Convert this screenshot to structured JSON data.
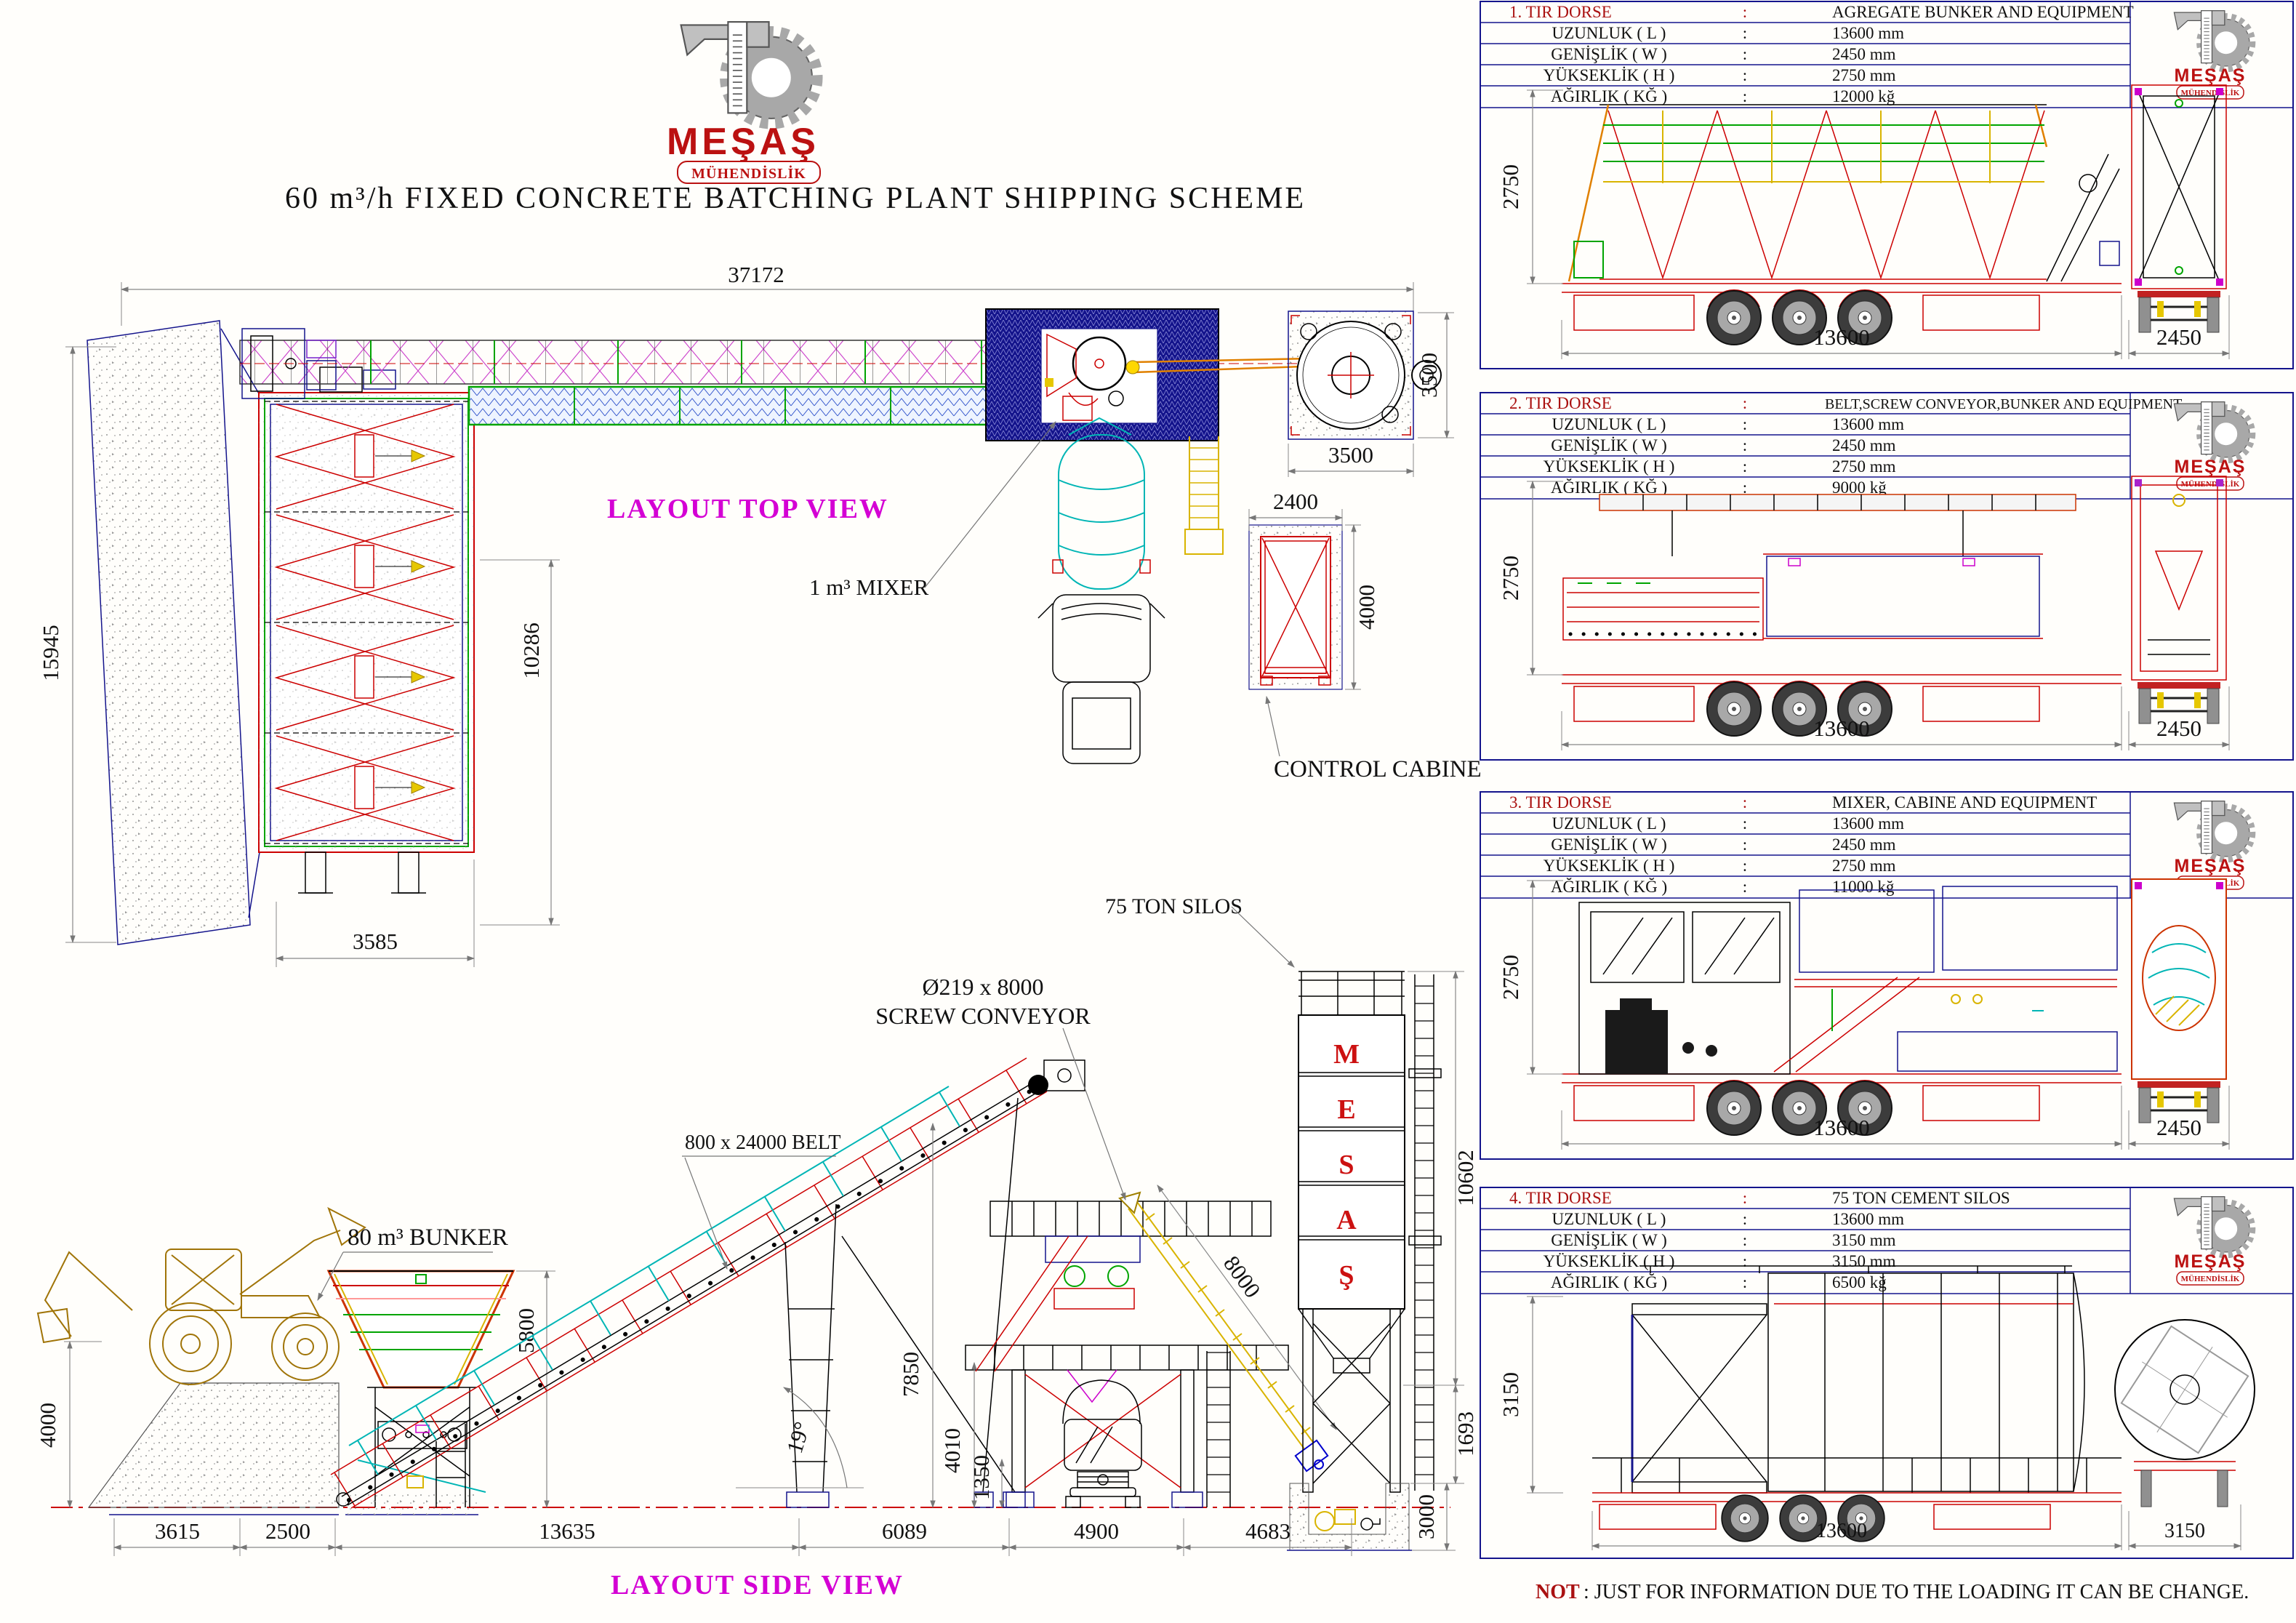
{
  "title": "60 m³/h FIXED CONCRETE BATCHING PLANT SHIPPING SCHEME",
  "logo": {
    "brand": "MEŞAŞ",
    "subtitle": "MÜHENDİSLİK"
  },
  "colors": {
    "cad_red": "#cc0000",
    "cad_navy": "#14148c",
    "cad_green": "#00a400",
    "cad_cyan": "#00b5b5",
    "cad_yellow": "#d9b400",
    "cad_magenta": "#cc00cc",
    "label_magenta": "#d400d4",
    "brand_red": "#bb1111"
  },
  "table_ui": {
    "colon": ":"
  },
  "top_view": {
    "view_label": "LAYOUT TOP VIEW",
    "mixer_label": "1 m³ MIXER",
    "control_cabine_label": "CONTROL CABINE",
    "dim_total_width": "37172",
    "dim_left_height": "15945",
    "dim_bunker_length": "10286",
    "dim_bunker_width": "3585",
    "dim_silo_side": "3500",
    "dim_silo_front": "3500",
    "dim_cabine_width": "2400",
    "dim_cabine_depth": "4000"
  },
  "side_view": {
    "view_label": "LAYOUT SIDE VIEW",
    "bunker_label": "80 m³ BUNKER",
    "belt_label": "800 x 24000 BELT",
    "screw_label_line1": "Ø219 x 8000",
    "screw_label_line2": "SCREW CONVEYOR",
    "silos_label": "75 TON SILOS",
    "silo_letters": [
      "M",
      "E",
      "S",
      "A",
      "Ş"
    ],
    "dim_ramp_height": "4000",
    "dim_bunker_height": "5800",
    "dim_belt_angle": "19°",
    "dim_platform_height": "7850",
    "dim_truck_clearance": "4010",
    "dim_footing_height": "1350",
    "dim_screw_length": "8000",
    "dim_silo_height": "10602",
    "dim_silo_cone": "1693",
    "dim_foundation_depth": "3000",
    "dim_ramp_length": "3615",
    "dim_feeder_gap": "2500",
    "dim_belt_span": "13635",
    "dim_mid_span": "6089",
    "dim_leg_span": "4900",
    "dim_silo_span": "4683"
  },
  "trucks": [
    {
      "no": "1. TIR DORSE",
      "cargo": "AGREGATE BUNKER AND EQUIPMENT",
      "rows": [
        {
          "label": "UZUNLUK ( L )",
          "value": "13600 mm"
        },
        {
          "label": "GENİŞLİK ( W )",
          "value": "2450 mm"
        },
        {
          "label": "YÜKSEKLİK ( H )",
          "value": "2750 mm"
        },
        {
          "label": "AĞIRLIK ( KĞ )",
          "value": "12000 kğ"
        }
      ],
      "dim_height": "2750",
      "dim_length": "13600",
      "dim_width": "2450"
    },
    {
      "no": "2. TIR DORSE",
      "cargo": "BELT,SCREW CONVEYOR,BUNKER AND EQUIPMENT",
      "rows": [
        {
          "label": "UZUNLUK ( L )",
          "value": "13600 mm"
        },
        {
          "label": "GENİŞLİK ( W )",
          "value": "2450 mm"
        },
        {
          "label": "YÜKSEKLİK ( H )",
          "value": "2750 mm"
        },
        {
          "label": "AĞIRLIK ( KĞ )",
          "value": "9000 kğ"
        }
      ],
      "dim_height": "2750",
      "dim_length": "13600",
      "dim_width": "2450"
    },
    {
      "no": "3. TIR DORSE",
      "cargo": "MIXER, CABINE AND EQUIPMENT",
      "rows": [
        {
          "label": "UZUNLUK ( L )",
          "value": "13600 mm"
        },
        {
          "label": "GENİŞLİK ( W )",
          "value": "2450 mm"
        },
        {
          "label": "YÜKSEKLİK ( H )",
          "value": "2750 mm"
        },
        {
          "label": "AĞIRLIK ( KĞ )",
          "value": "11000 kğ"
        }
      ],
      "dim_height": "2750",
      "dim_length": "13600",
      "dim_width": "2450"
    },
    {
      "no": "4. TIR DORSE",
      "cargo": "75 TON CEMENT SILOS",
      "rows": [
        {
          "label": "UZUNLUK ( L )",
          "value": "13600 mm"
        },
        {
          "label": "GENİŞLİK ( W )",
          "value": "3150 mm"
        },
        {
          "label": "YÜKSEKLİK ( H )",
          "value": "3150 mm"
        },
        {
          "label": "AĞIRLIK ( KĞ )",
          "value": "6500 kğ"
        }
      ],
      "dim_height": "3150",
      "dim_length": "13600",
      "dim_width": "3150"
    }
  ],
  "note": {
    "prefix": "NOT",
    "rest": ": JUST FOR INFORMATION DUE TO THE LOADING IT CAN BE CHANGE."
  }
}
